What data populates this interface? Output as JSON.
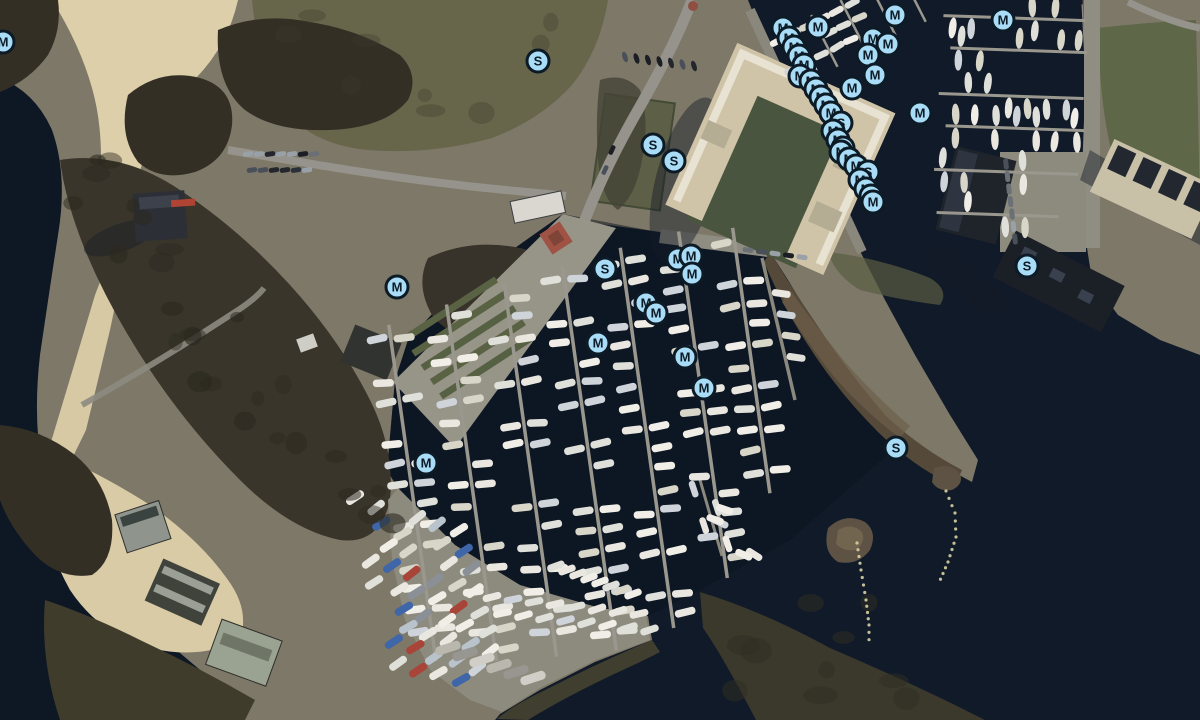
{
  "map": {
    "alt": "Aerial satellite view of a marina harbour: beach and park on the left, central yacht basin with jetties, apartment complex and second marina top right, boat storage yard at the bottom, open dark water lower right",
    "marker_style": {
      "fill": "#a9dcf6",
      "ring": "#0d1b26",
      "letter": "#0d1b26",
      "size_px": 26
    },
    "marker_counts": {
      "M": 41,
      "S": 8
    },
    "markers": [
      {
        "x": 3,
        "y": 42,
        "l": "M"
      },
      {
        "x": 538,
        "y": 61,
        "l": "S"
      },
      {
        "x": 653,
        "y": 145,
        "l": "S"
      },
      {
        "x": 674,
        "y": 161,
        "l": "S"
      },
      {
        "x": 397,
        "y": 287,
        "l": "M"
      },
      {
        "x": 605,
        "y": 269,
        "l": "S"
      },
      {
        "x": 598,
        "y": 343,
        "l": "M"
      },
      {
        "x": 426,
        "y": 463,
        "l": "M"
      },
      {
        "x": 685,
        "y": 357,
        "l": "M"
      },
      {
        "x": 704,
        "y": 388,
        "l": "M"
      },
      {
        "x": 896,
        "y": 448,
        "l": "S"
      },
      {
        "x": 1027,
        "y": 266,
        "l": "S"
      },
      {
        "x": 1003,
        "y": 20,
        "l": "M"
      },
      {
        "x": 920,
        "y": 113,
        "l": "M"
      },
      {
        "x": 678,
        "y": 259,
        "l": "M"
      },
      {
        "x": 691,
        "y": 256,
        "l": "M"
      },
      {
        "x": 692,
        "y": 274,
        "l": "M"
      },
      {
        "x": 646,
        "y": 303,
        "l": "M"
      },
      {
        "x": 656,
        "y": 313,
        "l": "M"
      },
      {
        "x": 873,
        "y": 39,
        "l": "M"
      },
      {
        "x": 888,
        "y": 44,
        "l": "M"
      },
      {
        "x": 868,
        "y": 55,
        "l": "M"
      },
      {
        "x": 875,
        "y": 75,
        "l": "M"
      },
      {
        "x": 852,
        "y": 88,
        "l": "M"
      },
      {
        "x": 895,
        "y": 15,
        "l": "M"
      },
      {
        "x": 783,
        "y": 28,
        "l": "M"
      },
      {
        "x": 818,
        "y": 27,
        "l": "M"
      },
      {
        "x": 789,
        "y": 38,
        "l": "M"
      },
      {
        "x": 794,
        "y": 47,
        "l": "M"
      },
      {
        "x": 799,
        "y": 56,
        "l": "M"
      },
      {
        "x": 804,
        "y": 65,
        "l": "M"
      },
      {
        "x": 800,
        "y": 76,
        "l": "M"
      },
      {
        "x": 811,
        "y": 81,
        "l": "M"
      },
      {
        "x": 816,
        "y": 89,
        "l": "M"
      },
      {
        "x": 821,
        "y": 97,
        "l": "M"
      },
      {
        "x": 826,
        "y": 105,
        "l": "M"
      },
      {
        "x": 831,
        "y": 113,
        "l": "M"
      },
      {
        "x": 841,
        "y": 123,
        "l": "S"
      },
      {
        "x": 833,
        "y": 131,
        "l": "M"
      },
      {
        "x": 838,
        "y": 140,
        "l": "M"
      },
      {
        "x": 843,
        "y": 148,
        "l": "M"
      },
      {
        "x": 841,
        "y": 152,
        "l": "M"
      },
      {
        "x": 849,
        "y": 159,
        "l": "M"
      },
      {
        "x": 856,
        "y": 166,
        "l": "M"
      },
      {
        "x": 868,
        "y": 172,
        "l": "S"
      },
      {
        "x": 860,
        "y": 180,
        "l": "M"
      },
      {
        "x": 866,
        "y": 189,
        "l": "M"
      },
      {
        "x": 871,
        "y": 196,
        "l": "M"
      },
      {
        "x": 873,
        "y": 202,
        "l": "M"
      }
    ],
    "buoy_lines": [
      {
        "points": [
          [
            857,
            543
          ],
          [
            861,
            570
          ],
          [
            866,
            600
          ],
          [
            869,
            625
          ],
          [
            869,
            647
          ]
        ]
      },
      {
        "points": [
          [
            946,
            491
          ],
          [
            955,
            513
          ],
          [
            956,
            537
          ],
          [
            948,
            562
          ],
          [
            938,
            585
          ]
        ]
      }
    ]
  },
  "palette": {
    "water": "#101a28",
    "water_deep": "#0b1320",
    "sand": "#dccfaa",
    "grass": "#67654a",
    "trees": "#342f25",
    "road": "#95938b",
    "pavement": "#8d8a7e",
    "building_beige": "#cfc4a8",
    "building_dark": "#23272e",
    "peninsula": "#55493a",
    "boat_white": "#e9e7df",
    "buoy": "#d6d0a2"
  }
}
